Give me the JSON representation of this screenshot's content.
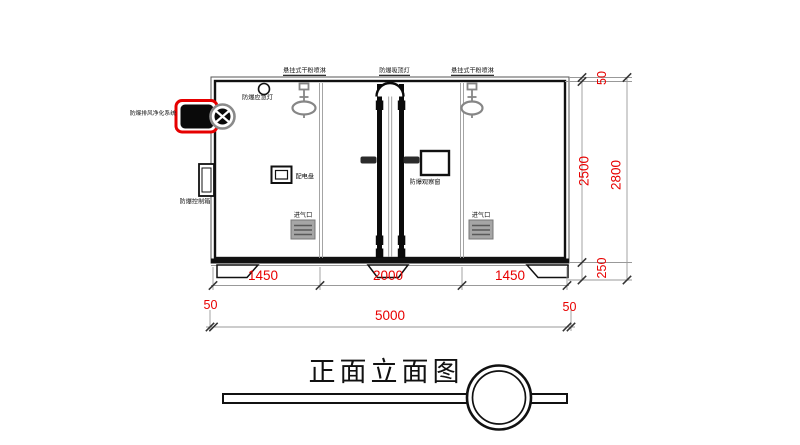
{
  "drawing": {
    "title": "正面立面图",
    "component_labels": {
      "sprinkler_left": "悬挂式干粉喷淋",
      "ceiling_light": "防爆吸顶灯",
      "sprinkler_right": "悬挂式干粉喷淋",
      "emergency_light": "防爆应急灯",
      "exhaust_purification_system": "防爆排风净化系统",
      "control_box": "防爆控制箱",
      "power_panel": "配电盘",
      "observation_window": "防爆观察窗",
      "air_inlet_left": "进气口",
      "air_inlet_right": "进气口"
    },
    "dimensions": {
      "width_segments": [
        "1450",
        "2000",
        "1450"
      ],
      "overall_width": [
        "50",
        "5000",
        "50"
      ],
      "height_top_offset": "50",
      "height_box": "2500",
      "height_base": "250",
      "overall_height": "2800"
    },
    "colors": {
      "dimension_text": "#e80000",
      "highlight": "#e60000",
      "linework": "#111111",
      "component_gray": "#8a8a8a"
    }
  }
}
